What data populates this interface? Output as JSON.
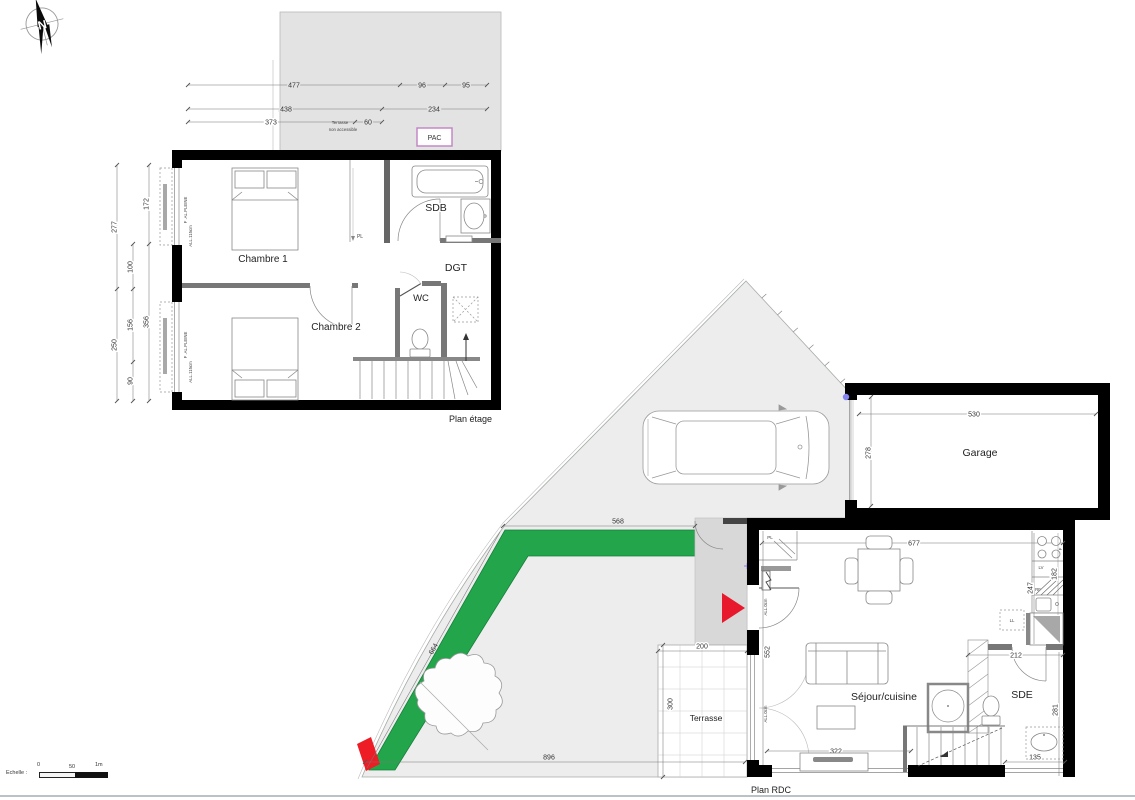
{
  "compass": {
    "n": "N"
  },
  "upper": {
    "title": "Plan étage",
    "pac": "PAC",
    "terrace_line1": "Terrasse",
    "terrace_line2": "non accessible",
    "window_type": "F .AL.PLEINE",
    "window_sill": "ALL.115cm",
    "rooms": {
      "chambre1": "Chambre 1",
      "chambre2": "Chambre 2",
      "sdb": "SDB",
      "dgt": "DGT",
      "wc": "WC",
      "pl": "PL"
    },
    "dims": {
      "a477": "477",
      "a96": "96",
      "a95": "95",
      "a438": "438",
      "a234": "234",
      "a373": "373",
      "a60": "60",
      "v277": "277",
      "v250": "250",
      "v100": "100",
      "v156": "156",
      "v90": "90",
      "v172": "172",
      "v356": "356"
    }
  },
  "ground": {
    "title": "Plan RDC",
    "rooms": {
      "garage": "Garage",
      "sejour": "Séjour/cuisine",
      "sde": "SDE",
      "terrasse": "Terrasse",
      "pl": "PL"
    },
    "labels": {
      "al0": "ALL.0cm",
      "ll": "LL",
      "lv": "LV",
      "rf": "RF",
      "f": "F"
    },
    "dims": {
      "g530": "530",
      "g278": "278",
      "s568": "568",
      "s664": "664",
      "s896": "896",
      "t200": "200",
      "t300": "300",
      "h677": "677",
      "k247": "247",
      "k182": "182",
      "d212": "212",
      "v281": "281",
      "b135": "135",
      "tv322": "322",
      "v552": "552"
    }
  },
  "scale": {
    "label": "Echelle :",
    "t0": "0",
    "t50": "50",
    "t1m": "1m"
  }
}
